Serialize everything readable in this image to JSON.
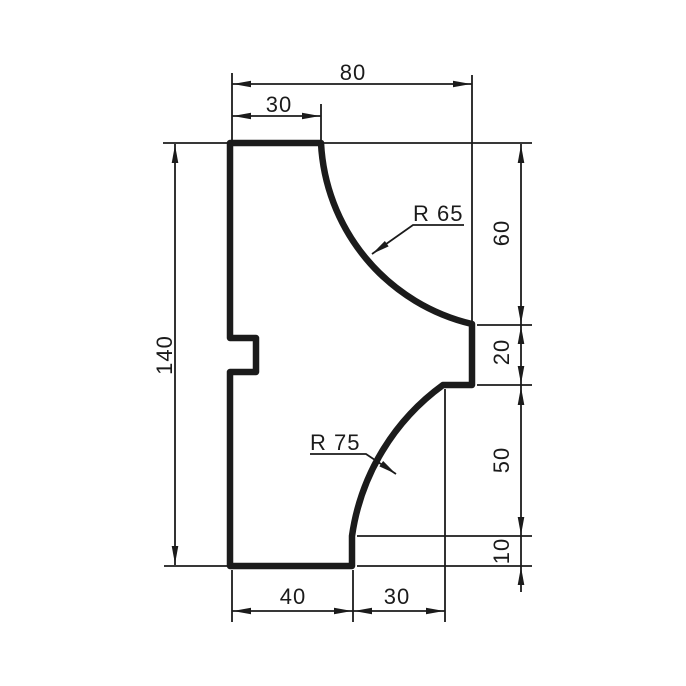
{
  "drawing": {
    "kind": "technical-profile-drawing",
    "dimensions": {
      "top_width": "80",
      "top_setback": "30",
      "overall_height": "140",
      "upper_right_height": "60",
      "step_height": "20",
      "lower_right_height": "50",
      "base_height": "10",
      "bottom_left_width": "40",
      "bottom_right_width": "30"
    },
    "radii": {
      "upper": "R 65",
      "lower": "R 75"
    },
    "colors": {
      "line": "#1b1b1b",
      "background": "#ffffff"
    }
  }
}
